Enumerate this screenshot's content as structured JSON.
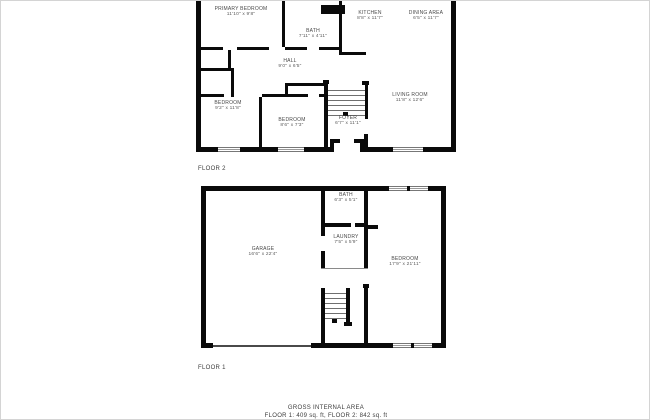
{
  "palette": {
    "wall": "#0a0a0a",
    "label_text": "#4a4a4a",
    "frame_border": "#d4d4d4",
    "background": "#ffffff"
  },
  "floor2": {
    "label": "FLOOR 2",
    "rooms": [
      {
        "name": "PRIMARY BEDROOM",
        "dims": "11'10\" x 9'8\""
      },
      {
        "name": "BATH",
        "dims": "7'11\" x 4'11\""
      },
      {
        "name": "KITCHEN",
        "dims": "8'8\" x 11'7\""
      },
      {
        "name": "DINING AREA",
        "dims": "6'5\" x 11'7\""
      },
      {
        "name": "HALL",
        "dims": "9'0\" x 6'5\""
      },
      {
        "name": "BEDROOM",
        "dims": "9'2\" x 11'8\""
      },
      {
        "name": "BEDROOM",
        "dims": "8'6\" x 7'3\""
      },
      {
        "name": "FOYER",
        "dims": "6'7\" x 11'1\""
      },
      {
        "name": "LIVING ROOM",
        "dims": "11'8\" x 12'6\""
      }
    ]
  },
  "floor1": {
    "label": "FLOOR 1",
    "rooms": [
      {
        "name": "BATH",
        "dims": "6'3\" x 5'1\""
      },
      {
        "name": "LAUNDRY",
        "dims": "7'5\" x 5'9\""
      },
      {
        "name": "GARAGE",
        "dims": "16'6\" x 22'4\""
      },
      {
        "name": "BEDROOM",
        "dims": "17'9\" x 21'11\""
      }
    ]
  },
  "footer": {
    "title": "GROSS INTERNAL AREA",
    "areas": "FLOOR 1: 409 sq. ft, FLOOR 2: 842 sq. ft"
  }
}
